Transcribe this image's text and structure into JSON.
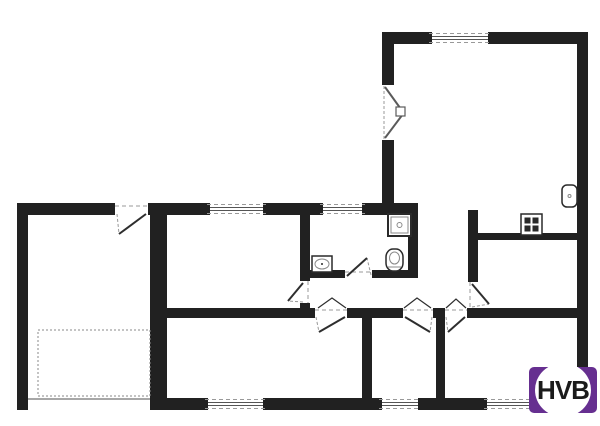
{
  "title": "House floor plan",
  "logo": {
    "text": "HVB",
    "background": "#662f90",
    "circle_color": "#ffffff",
    "text_color": "#1b1b1b"
  },
  "colors": {
    "bg": "#ffffff",
    "wall": "#212121",
    "leaf": "#2e2e2e",
    "french": "#5a5a5a",
    "dash": "#999999",
    "glass": "#555555",
    "fixture": "#2a2a2a",
    "fixture_light": "#8a8a8a"
  },
  "plan": {
    "walls": [
      {
        "id": "top-right-room-top",
        "x": 382,
        "y": 32,
        "w": 206,
        "h": 12
      },
      {
        "id": "right-exterior",
        "x": 577,
        "y": 32,
        "w": 11,
        "h": 378
      },
      {
        "id": "top-right-room-left",
        "x": 382,
        "y": 32,
        "w": 12,
        "h": 181
      },
      {
        "id": "band-top",
        "x": 17,
        "y": 203,
        "w": 401,
        "h": 12
      },
      {
        "id": "left-exterior",
        "x": 17,
        "y": 203,
        "w": 11,
        "h": 207
      },
      {
        "id": "bottom-exterior",
        "x": 17,
        "y": 398,
        "w": 571,
        "h": 12
      },
      {
        "id": "garage-right",
        "x": 150,
        "y": 203,
        "w": 17,
        "h": 207
      },
      {
        "id": "hall-bottom",
        "x": 150,
        "y": 308,
        "w": 438,
        "h": 10
      },
      {
        "id": "middle-room-east",
        "x": 300,
        "y": 203,
        "w": 10,
        "h": 115
      },
      {
        "id": "bathroom-bottom",
        "x": 300,
        "y": 270,
        "w": 118,
        "h": 8
      },
      {
        "id": "bathroom-east",
        "x": 408,
        "y": 210,
        "w": 10,
        "h": 68
      },
      {
        "id": "hall-east",
        "x": 468,
        "y": 210,
        "w": 10,
        "h": 100
      },
      {
        "id": "kitchen-top",
        "x": 478,
        "y": 233,
        "w": 110,
        "h": 7
      },
      {
        "id": "room-bc-divider",
        "x": 362,
        "y": 308,
        "w": 10,
        "h": 102
      },
      {
        "id": "room-cd-divider",
        "x": 436,
        "y": 308,
        "w": 9,
        "h": 102
      }
    ],
    "openings": [
      {
        "id": "french-door",
        "x": 382,
        "y": 85,
        "w": 12,
        "h": 55
      },
      {
        "id": "garage-entry",
        "x": 115,
        "y": 203,
        "w": 33,
        "h": 12
      },
      {
        "id": "middle-room-door",
        "x": 300,
        "y": 281,
        "w": 10,
        "h": 22
      },
      {
        "id": "bathroom-door",
        "x": 345,
        "y": 270,
        "w": 27,
        "h": 8
      },
      {
        "id": "kitchen-door",
        "x": 468,
        "y": 282,
        "w": 10,
        "h": 26
      },
      {
        "id": "room-b-door",
        "x": 315,
        "y": 308,
        "w": 32,
        "h": 10
      },
      {
        "id": "room-c-door",
        "x": 403,
        "y": 308,
        "w": 30,
        "h": 10
      },
      {
        "id": "room-d-door",
        "x": 445,
        "y": 308,
        "w": 22,
        "h": 10
      },
      {
        "id": "garage-door",
        "x": 28,
        "y": 398,
        "w": 122,
        "h": 12
      }
    ],
    "windows": [
      {
        "id": "living-top",
        "x": 432,
        "y": 32,
        "w": 56,
        "h": 12
      },
      {
        "id": "front-left",
        "x": 210,
        "y": 203,
        "w": 53,
        "h": 12
      },
      {
        "id": "bathroom",
        "x": 323,
        "y": 203,
        "w": 39,
        "h": 12
      },
      {
        "id": "rear-left",
        "x": 208,
        "y": 398,
        "w": 55,
        "h": 12
      },
      {
        "id": "rear-middle",
        "x": 382,
        "y": 398,
        "w": 36,
        "h": 12
      },
      {
        "id": "rear-right",
        "x": 487,
        "y": 398,
        "w": 45,
        "h": 12
      }
    ],
    "doors": [
      {
        "id": "garage-entry",
        "leaf": [
          146,
          214,
          119,
          234
        ],
        "chord": [
          117,
          214,
          119,
          234
        ]
      },
      {
        "id": "middle-room",
        "leaf": [
          303,
          283,
          288,
          301
        ],
        "chord": [
          303,
          302,
          288,
          301
        ]
      },
      {
        "id": "bathroom",
        "leaf": [
          347,
          276,
          367,
          258
        ],
        "chord": [
          371,
          275,
          367,
          258
        ]
      },
      {
        "id": "kitchen",
        "leaf": [
          472,
          284,
          489,
          304
        ],
        "chord": [
          472,
          307,
          489,
          304
        ]
      },
      {
        "id": "room-b",
        "leaf": [
          345,
          317,
          319,
          332
        ],
        "chord": [
          316,
          317,
          319,
          332
        ]
      },
      {
        "id": "room-c",
        "leaf": [
          405,
          317,
          430,
          332
        ],
        "chord": [
          432,
          317,
          430,
          332
        ]
      },
      {
        "id": "room-d",
        "leaf": [
          465,
          317,
          448,
          332
        ],
        "chord": [
          446,
          317,
          448,
          332
        ]
      }
    ],
    "french_door": {
      "dash": [
        384,
        86,
        384,
        139
      ],
      "leaves": [
        [
          385,
          87,
          403,
          112
        ],
        [
          385,
          138,
          403,
          114
        ]
      ],
      "knob": [
        396,
        107,
        9,
        9
      ]
    },
    "door_marks": {
      "dashes": [
        [
          115,
          206,
          148,
          206
        ],
        [
          308,
          281,
          308,
          303
        ],
        [
          345,
          272,
          372,
          272
        ],
        [
          470,
          282,
          470,
          308
        ],
        [
          315,
          310,
          347,
          310
        ],
        [
          403,
          310,
          433,
          310
        ],
        [
          445,
          310,
          467,
          310
        ]
      ],
      "vees": [
        [
          318,
          308,
          332,
          298,
          346,
          308
        ],
        [
          404,
          308,
          417,
          298,
          431,
          308
        ],
        [
          446,
          308,
          456,
          299,
          466,
          308
        ]
      ]
    },
    "fixtures": [
      {
        "type": "shower",
        "x": 388,
        "y": 214,
        "w": 23,
        "h": 22
      },
      {
        "type": "toilet",
        "x": 386,
        "y": 249,
        "w": 17,
        "h": 22
      },
      {
        "type": "sink",
        "x": 312,
        "y": 256,
        "w": 20,
        "h": 16
      },
      {
        "type": "basin",
        "x": 562,
        "y": 185,
        "w": 15,
        "h": 22
      },
      {
        "type": "chimney",
        "x": 521,
        "y": 214,
        "w": 21,
        "h": 21
      },
      {
        "type": "dotted-area",
        "x": 38,
        "y": 330,
        "w": 112,
        "h": 66
      },
      {
        "type": "garage-door-line",
        "x": 28,
        "y": 399,
        "w": 122,
        "h": 0
      }
    ]
  }
}
